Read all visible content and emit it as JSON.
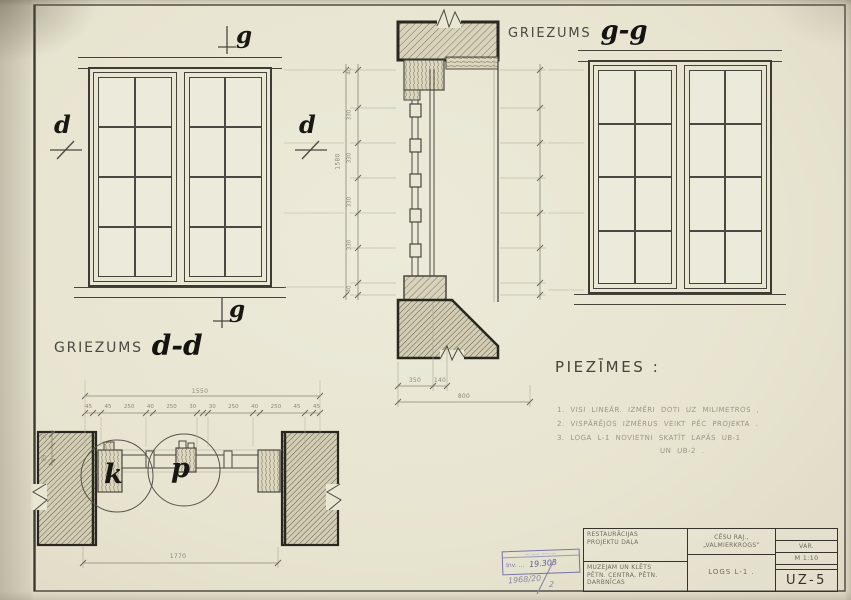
{
  "sheet": {
    "section_label_prefix": "GRIEZUMS",
    "section_gg": "g-g",
    "section_dd": "d-d",
    "mark_g": "g",
    "mark_d": "d",
    "detail_k": "k",
    "detail_p": "p"
  },
  "notes": {
    "heading": "PIEZĪMES :",
    "items": [
      "1. VISI LINEĀR. IZMĒRI DOTI UZ MILIMETROS ,",
      "2. VISPĀRĒJOS IZMĒRUS VEIKT PĒC PROJEKTA .",
      "3. LOGA L-1 NOVIETNI SKATĪT LAPĀS UB-1"
    ],
    "item3_cont": "UN UB-2 ."
  },
  "dims": {
    "gg_seg_a": "350",
    "gg_seg_b": "140",
    "gg_total": "800",
    "gg_height": "1580",
    "gg_left_segments": [
      "40",
      "330",
      "330",
      "330",
      "330",
      "40"
    ],
    "dd_total_top": "1550",
    "dd_segments": [
      "45",
      "45",
      "250",
      "40",
      "250",
      "30",
      "30",
      "250",
      "40",
      "250",
      "45",
      "45"
    ],
    "dd_total_bottom": "1770",
    "dd_left_segments": [
      "30",
      "85"
    ]
  },
  "title_block": {
    "org_line1": "RESTAURĀCIJAS",
    "org_line2": "PROJEKTU DAĻA",
    "location_line1": "CĒSU RAJ.,",
    "location_line2": "„VALMIERKROGS”",
    "object_line1": "MUZEJAM UN KLĒTS",
    "object_line2": "PĒTN. CENTRA, PĒTN.",
    "object_line3": "DARBNĪCAS",
    "drawing_title": "LOGS L-1 .",
    "stage": "VAR.",
    "scale": "M 1:10",
    "sheet_number": "UZ-5"
  },
  "stamp": {
    "header": "—··——  ——··—",
    "inv_prefix": "Inv. ...",
    "inv_number": "19.303",
    "year_note": "1968/20",
    "copy_number": "2"
  }
}
